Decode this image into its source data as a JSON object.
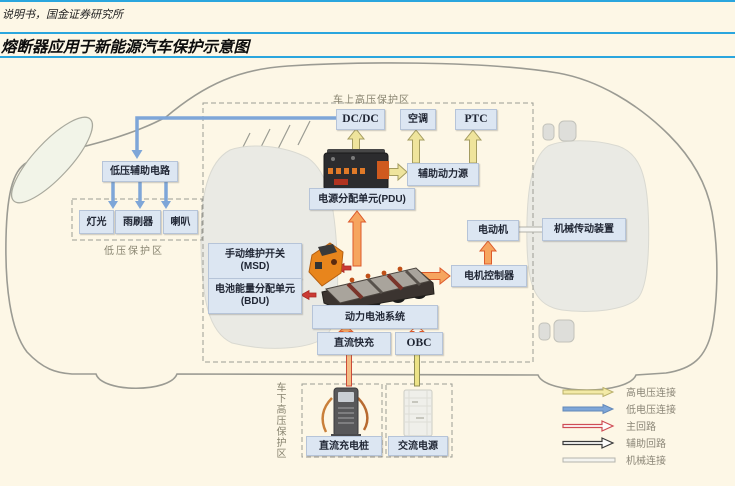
{
  "header": {
    "source_text": "说明书，国金证券研究所",
    "title": "熔断器应用于新能源汽车保护示意图"
  },
  "zones": {
    "hv_onboard": "车上高压保护区",
    "lv_protect": "低压保护区",
    "hv_under": "车下高压保护区"
  },
  "boxes": {
    "dcdc": "DC/DC",
    "air_conditioner": "空调",
    "ptc": "PTC",
    "aux_power": "辅助动力源",
    "pdu": "电源分配单元(PDU)",
    "lv_aux": "低压辅助电路",
    "light": "灯光",
    "wiper": "雨刷器",
    "horn": "喇叭",
    "msd_line1": "手动维护开关",
    "msd_line2": "(MSD)",
    "bdu_line1": "电池能量分配单元",
    "bdu_line2": "(BDU)",
    "battery_system": "动力电池系统",
    "dc_fast": "直流快充",
    "obc": "OBC",
    "motor": "电动机",
    "motor_controller": "电机控制器",
    "mechanical_drive": "机械传动装置",
    "dc_charger": "直流充电桩",
    "ac_source": "交流电源"
  },
  "legend": {
    "items": [
      {
        "label": "高电压连接",
        "color": "#f3eaa6"
      },
      {
        "label": "低电压连接",
        "color": "#7ea6d8"
      },
      {
        "label": "主回路",
        "color": "#cf4c55"
      },
      {
        "label": "辅助回路",
        "color": "#3a3a3a"
      },
      {
        "label": "机械连接",
        "color": "#c9c9c2"
      }
    ]
  },
  "colors": {
    "page_bg": "#fdf7e6",
    "rule_blue": "#2aa6de",
    "box_fill": "#dce6f2",
    "box_border": "#b6c4d8",
    "arrow_yellow": "#efe49c",
    "arrow_blue": "#7ea6d8",
    "arrow_orange": "#f6a55f",
    "arrow_orange_border": "#dd5a2c",
    "arrow_red": "#cb3a34",
    "dash_gray": "#9c9c94",
    "car_outline": "#9b9b93"
  }
}
